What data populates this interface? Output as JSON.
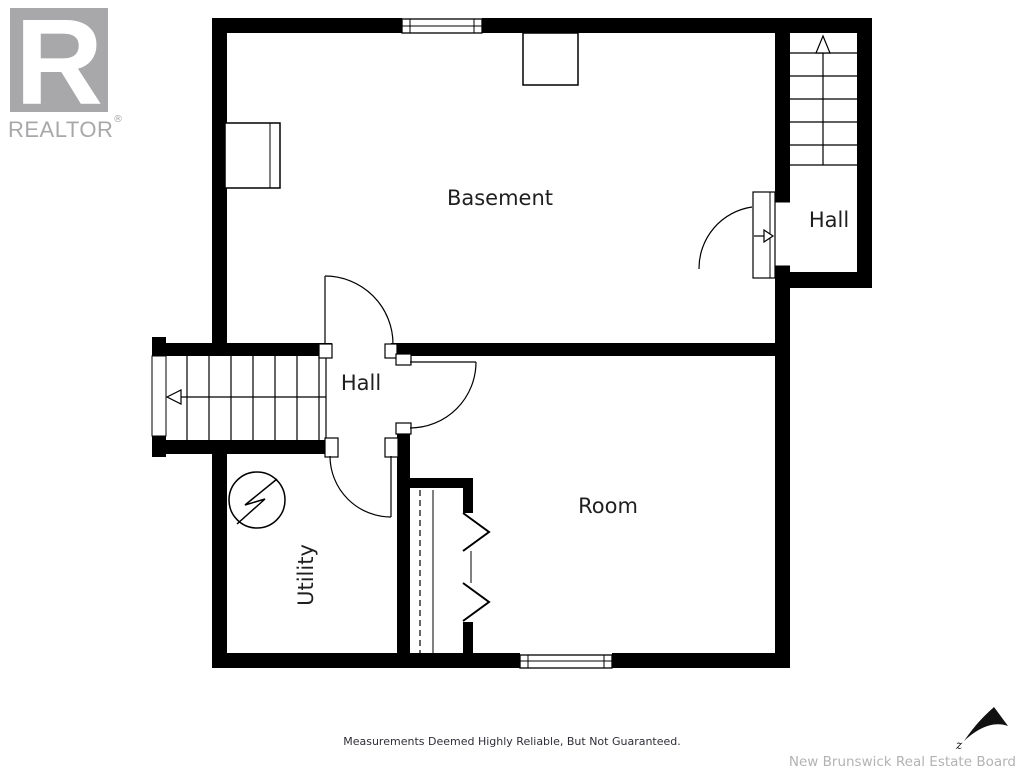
{
  "branding": {
    "realtor_logo": {
      "letter": "R",
      "wordmark": "REALTOR",
      "registered_mark": "®"
    }
  },
  "floor_plan": {
    "rooms": {
      "basement": {
        "label": "Basement"
      },
      "upper_hall": {
        "label": "Hall"
      },
      "lower_hall": {
        "label": "Hall"
      },
      "room": {
        "label": "Room"
      },
      "utility": {
        "label": "Utility"
      }
    },
    "symbols": {
      "electrical_panel": "circle-with-lightning-zigzag",
      "upper_stairs_direction": "arrow-up",
      "left_stairs_direction": "arrow-left",
      "entry_door_direction": "arrow-right",
      "north_arrow": "northeast-dart"
    },
    "compass_label": "z"
  },
  "footer": {
    "disclaimer": "Measurements Deemed Highly Reliable, But Not Guaranteed.",
    "attribution": "New Brunswick Real Estate Board"
  },
  "colors": {
    "walls": "#000000",
    "logo_gray": "#a8a8aa",
    "label_text": "#1f1f1f",
    "disclaimer_text": "#2e2e38",
    "attribution_text": "#b3b3b3"
  }
}
